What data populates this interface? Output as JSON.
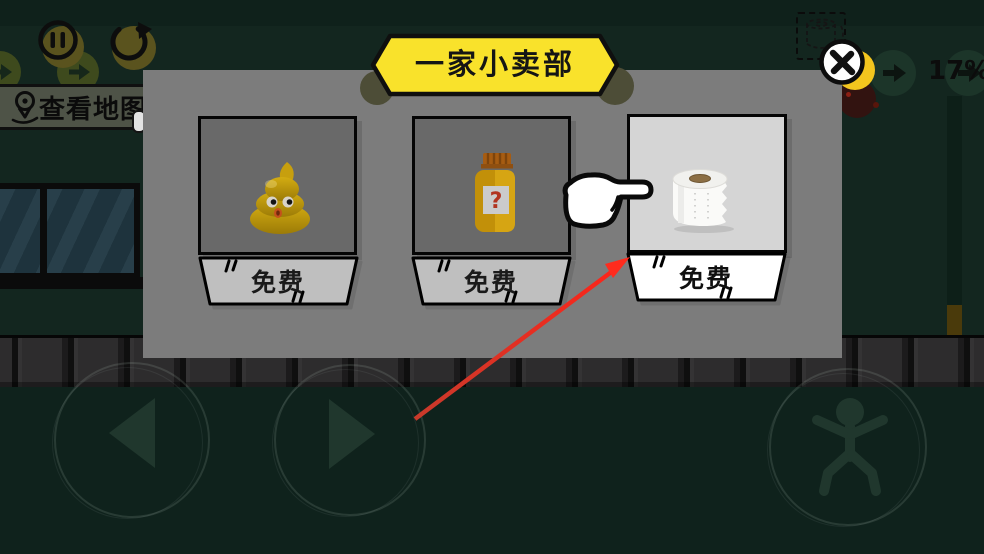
{
  "hud": {
    "pause_icon": "pause-icon",
    "restart_icon": "restart-icon",
    "map_button": {
      "label": "查看地图",
      "icon": "location-pin-icon"
    },
    "progress": "17%",
    "item_slot_icon": "toilet-paper-outline-icon"
  },
  "shop": {
    "title": "一家小卖部",
    "close_icon": "close-x-icon",
    "items": [
      {
        "name": "poop",
        "price_label": "免费",
        "state": "dimmed"
      },
      {
        "name": "mystery-jar",
        "price_label": "免费",
        "state": "dimmed"
      },
      {
        "name": "toilet-paper",
        "price_label": "免费",
        "state": "highlighted"
      }
    ],
    "tutorial": {
      "hand_icon": "pointing-hand-icon",
      "arrow_icon": "red-arrow-icon"
    }
  },
  "controls": {
    "left_icon": "left-arrow-icon",
    "right_icon": "right-arrow-icon",
    "jump_icon": "jump-figure-icon"
  },
  "colors": {
    "banner_yellow": "#f9e22b",
    "coin_yellow": "#f3c51e",
    "dialog_gray": "#7c7c7c",
    "arrow_red": "#f63428",
    "highlight_white": "#ffffff"
  }
}
